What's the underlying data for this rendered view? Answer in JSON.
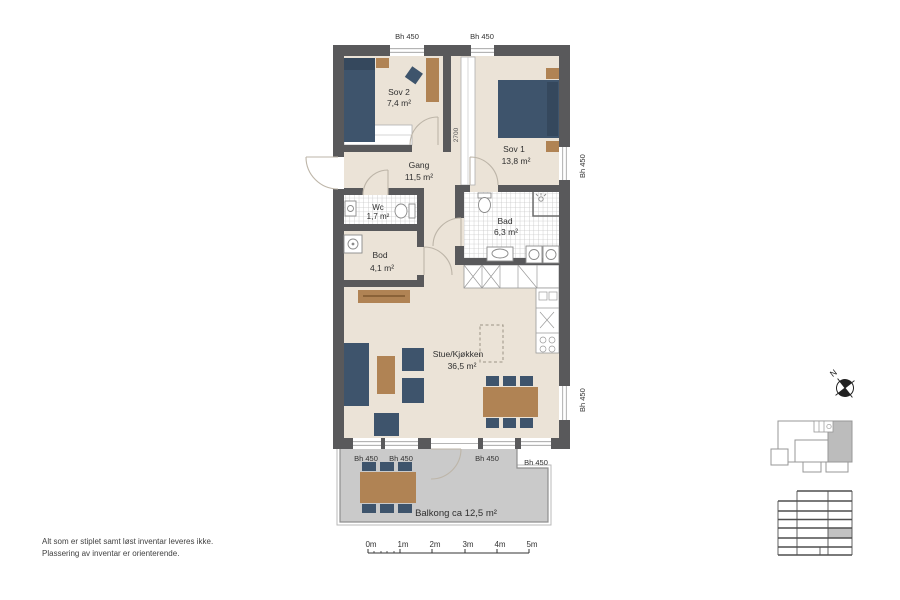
{
  "rooms": {
    "sov2": {
      "name": "Sov 2",
      "area": "7,4 m²"
    },
    "sov1": {
      "name": "Sov 1",
      "area": "13,8 m²"
    },
    "gang": {
      "name": "Gang",
      "area": "11,5 m²"
    },
    "wc": {
      "name": "Wc",
      "area": "1,7 m²"
    },
    "bad": {
      "name": "Bad",
      "area": "6,3 m²"
    },
    "bod": {
      "name": "Bod",
      "area": "4,1 m²"
    },
    "stue": {
      "name": "Stue/Kjøkken",
      "area": "36,5 m²"
    },
    "balkong": {
      "name": "Balkong ca 12,5 m²"
    }
  },
  "window_sill_label": "Bh 450",
  "dimensions": {
    "sov2_wardrobe": "1900",
    "sov1_wardrobe": "2700"
  },
  "north_label": "N",
  "scale_bar": {
    "ticks": [
      "0m",
      "1m",
      "2m",
      "3m",
      "4m",
      "5m"
    ]
  },
  "disclaimer": {
    "line1": "Alt som er stiplet samt løst inventar leveres ikke.",
    "line2": "Plassering av inventar er orienterende."
  },
  "colors": {
    "wall": "#59595b",
    "floor": "#ebe3d7",
    "balcony": "#cacaca",
    "furniture_dark_blue": "#3e546c",
    "furniture_wood": "#b08354",
    "door_arc": "#bdb5a8"
  }
}
